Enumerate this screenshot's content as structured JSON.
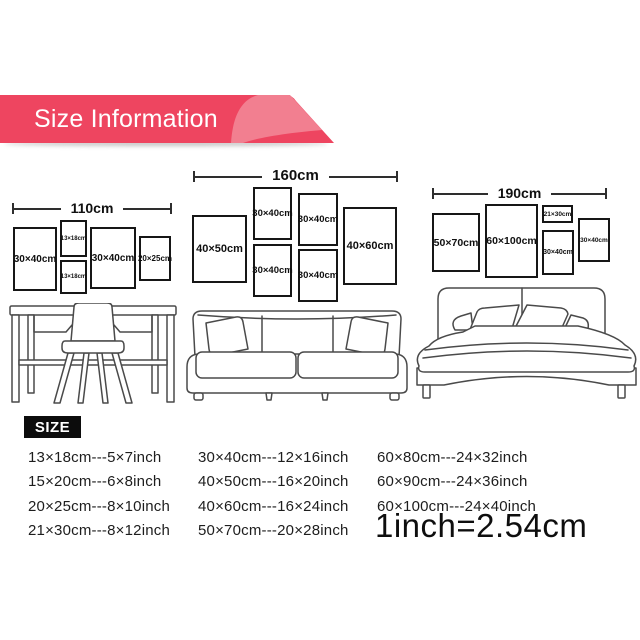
{
  "banner": {
    "title": "Size Information",
    "bg_color": "#ee4560",
    "accent_color": "#f27f90"
  },
  "scenes": [
    {
      "name": "desk",
      "width_label": "110cm",
      "frames": [
        "30×40cm",
        "13×18cm",
        "13×18cm",
        "30×40cm",
        "20×25cm"
      ]
    },
    {
      "name": "sofa",
      "width_label": "160cm",
      "frames": [
        "40×50cm",
        "30×40cm",
        "30×40cm",
        "30×40cm",
        "30×40cm",
        "40×60cm"
      ]
    },
    {
      "name": "bed",
      "width_label": "190cm",
      "frames": [
        "50×70cm",
        "60×100cm",
        "21×30cm",
        "30×40cm",
        "30×40cm"
      ]
    }
  ],
  "size_table": {
    "heading": "SIZE",
    "col1": [
      "13×18cm---5×7inch",
      "15×20cm---6×8inch",
      "20×25cm---8×10inch",
      "21×30cm---8×12inch"
    ],
    "col2": [
      "30×40cm---12×16inch",
      "40×50cm---16×20inch",
      "40×60cm---16×24inch",
      "50×70cm---20×28inch"
    ],
    "col3": [
      "60×80cm---24×32inch",
      "60×90cm---24×36inch",
      "60×100cm---24×40inch"
    ],
    "conversion": "1inch=2.54cm"
  }
}
